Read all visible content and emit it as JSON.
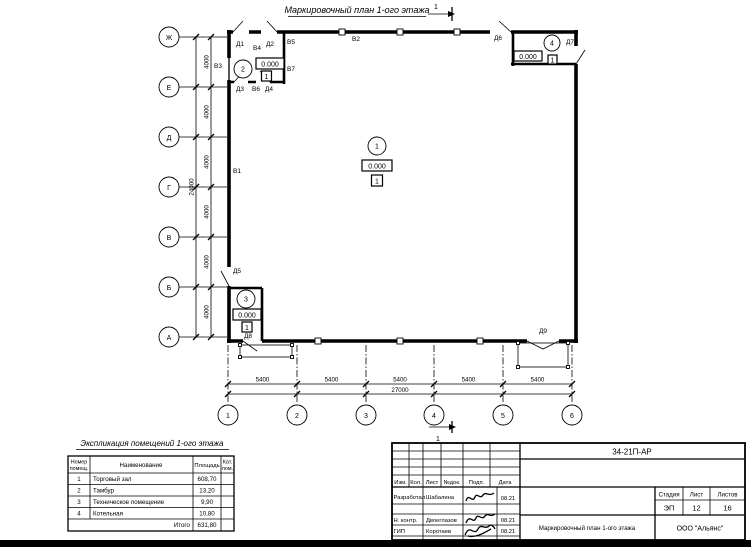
{
  "page": {
    "title": "Маркировочный план 1-ого этажа",
    "section_label": "1"
  },
  "plan": {
    "axes_left": [
      "Ж",
      "Е",
      "Д",
      "Г",
      "В",
      "Б",
      "А"
    ],
    "axes_bottom": [
      "1",
      "2",
      "3",
      "4",
      "5",
      "6"
    ],
    "dims_left": [
      "4000",
      "4000",
      "4000",
      "4000",
      "4000",
      "4000"
    ],
    "dim_left_total": "24000",
    "dims_bottom": [
      "5400",
      "5400",
      "5400",
      "5400",
      "5400"
    ],
    "dim_bottom_total": "27000",
    "markers": [
      {
        "num": "1",
        "elev": "0.000",
        "floor": "1"
      },
      {
        "num": "2",
        "elev": "0.000",
        "floor": "1"
      },
      {
        "num": "3",
        "elev": "0.000",
        "floor": "1"
      },
      {
        "num": "4",
        "elev": "0.000",
        "floor": "1"
      }
    ],
    "doors": {
      "d1": "Д1",
      "d2": "Д2",
      "d3": "Д3",
      "d4": "Д4",
      "d5": "Д5",
      "d6": "Д6",
      "d7": "Д7",
      "d8": "Д8",
      "d9": "Д9"
    },
    "windows": {
      "v1": "В1",
      "v2": "В2",
      "v3": "В3",
      "v4": "В4",
      "v5": "В5",
      "v6": "В6",
      "v7": "В7"
    }
  },
  "explication": {
    "title": "Экспликация помещений 1-ого этажа",
    "col_num_1": "Номер",
    "col_num_2": "помещ.",
    "col_name": "Наименование",
    "col_area": "Площадь",
    "col_cat_1": "Кат.",
    "col_cat_2": "пом.",
    "rows": [
      {
        "num": "1",
        "name": "Торговый зал",
        "area": "608,70"
      },
      {
        "num": "2",
        "name": "Тамбур",
        "area": "13,20"
      },
      {
        "num": "3",
        "name": "Техническое помещение",
        "area": "9,90"
      },
      {
        "num": "4",
        "name": "Котельная",
        "area": "10,80"
      }
    ],
    "total_label": "Итого",
    "total_area": "631,80"
  },
  "titleblock": {
    "doc_number": "34-21П-АР",
    "cols": [
      "Изм.",
      "Кол.",
      "Лист",
      "№док.",
      "Подп.",
      "Дата"
    ],
    "rows": [
      {
        "role": "Разработал",
        "name": "Шабалина",
        "date": "08.21"
      },
      {
        "role": "Н. контр.",
        "name": "Двоеглазов",
        "date": "08.21"
      },
      {
        "role": "ГИП",
        "name": "Коротаев",
        "date": "08.21"
      }
    ],
    "stage_label": "Стадия",
    "sheet_label": "Лист",
    "sheets_label": "Листов",
    "stage": "ЭП",
    "sheet": "12",
    "sheets": "16",
    "drawing_title": "Маркировочный план 1-ого этажа",
    "company": "ООО \"Альянс\""
  }
}
